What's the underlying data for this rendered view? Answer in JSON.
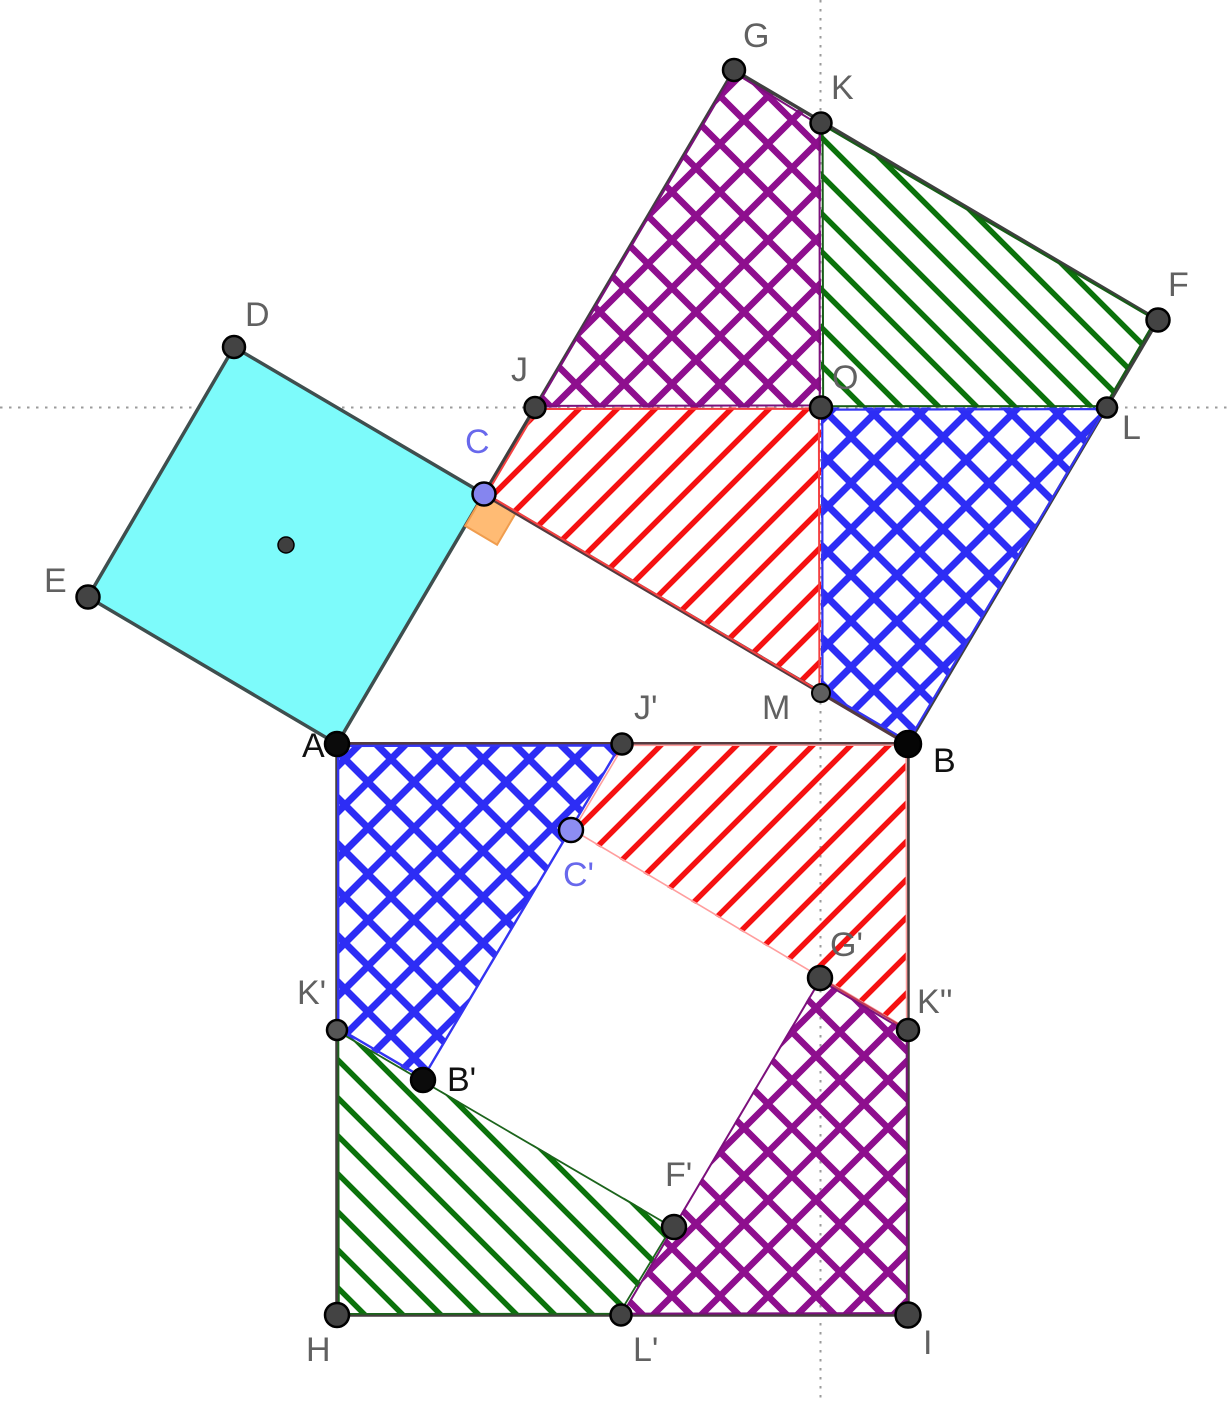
{
  "figure": {
    "canvas": {
      "w": 1227,
      "h": 1401,
      "background": "#ffffff"
    },
    "patterns": [
      {
        "id": "redHatch",
        "size": 38,
        "dirs": [
          "up"
        ],
        "color": "#f51111",
        "width": 5.5
      },
      {
        "id": "greenHatch",
        "size": 38,
        "dirs": [
          "down"
        ],
        "color": "#0b720b",
        "width": 5.5
      },
      {
        "id": "blueCross",
        "size": 46,
        "dirs": [
          "up",
          "down"
        ],
        "color": "#2d2df5",
        "width": 7
      },
      {
        "id": "purpleCross",
        "size": 48,
        "dirs": [
          "up",
          "down"
        ],
        "color": "#8e0f8e",
        "width": 6.5
      }
    ],
    "points": {
      "A": [
        337,
        744
      ],
      "B": [
        908,
        744
      ],
      "C": [
        484,
        494
      ],
      "D": [
        234,
        347
      ],
      "E": [
        88,
        597
      ],
      "G": [
        734,
        70
      ],
      "K": [
        821,
        123
      ],
      "F": [
        1158,
        320
      ],
      "J": [
        535,
        407.5
      ],
      "O": [
        821,
        407.5
      ],
      "L": [
        1107,
        407.5
      ],
      "M": [
        821,
        693
      ],
      "H": [
        337,
        1315
      ],
      "I": [
        908,
        1315
      ],
      "J2": [
        622,
        744
      ],
      "C2": [
        571,
        830
      ],
      "B2": [
        423,
        1080
      ],
      "K2": [
        337,
        1030
      ],
      "K3": [
        908,
        1030
      ],
      "G2": [
        820,
        978
      ],
      "F2": [
        674,
        1227
      ],
      "L2": [
        621,
        1315
      ],
      "CTR": [
        286,
        545
      ]
    },
    "layers": [
      {
        "kind": "dotline",
        "name": "ref-line-horizontal",
        "pts": [
          [
            0,
            407.5
          ],
          [
            1227,
            407.5
          ]
        ],
        "stroke": "#9b9b9b",
        "width": 2,
        "dash": "2.5 6.5",
        "inter": false
      },
      {
        "kind": "dotline",
        "name": "ref-line-vertical",
        "pts": [
          [
            820.5,
            0
          ],
          [
            820.5,
            1401
          ]
        ],
        "stroke": "#9b9b9b",
        "width": 2,
        "dash": "2.5 6.5",
        "inter": false
      },
      {
        "kind": "fill",
        "name": "square-ACDE",
        "pts": [
          "A",
          "C",
          "D",
          "E"
        ],
        "fill": "#7dfbfb",
        "stroke": "#3f4e4e",
        "width": 3.5,
        "inter": true
      },
      {
        "kind": "fill",
        "name": "right-angle-marker",
        "pts": [
          [
            484,
            494
          ],
          [
            515.9,
            512.8
          ],
          [
            497.1,
            544.7
          ],
          [
            465.2,
            525.9
          ]
        ],
        "fill": "#ffbb74",
        "stroke": "#f09d4e",
        "width": 2,
        "inter": false
      },
      {
        "kind": "fill",
        "name": "piece-upper-red",
        "pts": [
          "J",
          "O",
          "M",
          "C"
        ],
        "fill": "pattern:redHatch",
        "inter": true
      },
      {
        "kind": "fill",
        "name": "piece-upper-purple",
        "pts": [
          "G",
          "K",
          "O",
          "J"
        ],
        "fill": "pattern:purpleCross",
        "inter": true
      },
      {
        "kind": "fill",
        "name": "piece-upper-green",
        "pts": [
          "K",
          "F",
          "L",
          "O"
        ],
        "fill": "pattern:greenHatch",
        "inter": true
      },
      {
        "kind": "fill",
        "name": "piece-upper-blue",
        "pts": [
          "O",
          "L",
          "B",
          "M"
        ],
        "fill": "pattern:blueCross",
        "inter": true
      },
      {
        "kind": "fill",
        "name": "piece-lower-green",
        "pts": [
          "K2",
          "F2",
          "L2",
          "H"
        ],
        "fill": "pattern:greenHatch",
        "inter": true
      },
      {
        "kind": "fill",
        "name": "piece-lower-purple",
        "pts": [
          "G2",
          "K3",
          "I",
          "L2"
        ],
        "fill": "pattern:purpleCross",
        "inter": true
      },
      {
        "kind": "fill",
        "name": "piece-lower-red",
        "pts": [
          "J2",
          "B",
          "K3",
          "C2"
        ],
        "fill": "pattern:redHatch",
        "inter": true
      },
      {
        "kind": "fill",
        "name": "piece-lower-blue",
        "pts": [
          "A",
          "J2",
          "B2",
          "K2"
        ],
        "fill": "pattern:blueCross",
        "inter": true
      },
      {
        "kind": "edge",
        "name": "square-CGFB-border",
        "pts": [
          "C",
          "G",
          "F",
          "B"
        ],
        "stroke": "#3f3f3f",
        "width": 3.5,
        "inset": 0,
        "close": true,
        "inter": true
      },
      {
        "kind": "seg",
        "name": "side-CB",
        "pts": [
          "C",
          "B"
        ],
        "stroke": "#553b40",
        "width": 4,
        "inter": true
      },
      {
        "kind": "seg",
        "name": "side-AB",
        "pts": [
          "A",
          "B"
        ],
        "stroke": "#553b40",
        "width": 4,
        "inter": true
      },
      {
        "kind": "edge",
        "name": "square-ABIH-border",
        "pts": [
          "B",
          "I",
          "H",
          "A"
        ],
        "stroke": "#453e3e",
        "width": 3.5,
        "inset": 0,
        "close": false,
        "inter": true
      },
      {
        "kind": "edge",
        "name": "piece-upper-red-edge",
        "pts": [
          "J",
          "O",
          "M",
          "C"
        ],
        "stroke": "#f54040",
        "width": 2,
        "inset": 2.5,
        "close": true,
        "inter": false
      },
      {
        "kind": "edge",
        "name": "piece-upper-purple-edge",
        "pts": [
          "G",
          "K",
          "O",
          "J"
        ],
        "stroke": "#7c107c",
        "width": 2,
        "inset": 2.5,
        "close": true,
        "inter": false
      },
      {
        "kind": "edge",
        "name": "piece-upper-green-edge",
        "pts": [
          "K",
          "F",
          "L",
          "O"
        ],
        "stroke": "#175c17",
        "width": 2,
        "inset": 2.5,
        "close": true,
        "inter": false
      },
      {
        "kind": "edge",
        "name": "piece-upper-blue-edge",
        "pts": [
          "O",
          "L",
          "B",
          "M"
        ],
        "stroke": "#3434f2",
        "width": 2.2,
        "inset": 2.5,
        "close": true,
        "inter": false
      },
      {
        "kind": "edge",
        "name": "piece-lower-green-edge",
        "pts": [
          "K2",
          "F2",
          "L2",
          "H"
        ],
        "stroke": "#1c641c",
        "width": 1.8,
        "inset": 2.2,
        "close": true,
        "inter": false
      },
      {
        "kind": "edge",
        "name": "piece-lower-purple-edge",
        "pts": [
          "G2",
          "K3",
          "I",
          "L2"
        ],
        "stroke": "#7c107c",
        "width": 2,
        "inset": 2.2,
        "close": true,
        "inter": false
      },
      {
        "kind": "edge",
        "name": "piece-lower-red-edge",
        "pts": [
          "J2",
          "B",
          "K3",
          "C2"
        ],
        "stroke": "#ff9e9e",
        "width": 1.6,
        "inset": 2.2,
        "close": true,
        "inter": false
      },
      {
        "kind": "seg",
        "name": "edge-G2-K3-crimson",
        "pts": [
          "G2",
          "K3"
        ],
        "stroke": "#c23a55",
        "width": 2,
        "inter": false
      },
      {
        "kind": "edge",
        "name": "piece-lower-blue-edge",
        "pts": [
          "A",
          "J2",
          "B2",
          "K2"
        ],
        "stroke": "#3434f2",
        "width": 2.4,
        "inset": 2.2,
        "close": true,
        "inter": false
      }
    ],
    "dots": [
      {
        "name": "G",
        "p": "G",
        "r": 11,
        "fill": "#434343",
        "sw": 2.5
      },
      {
        "name": "K",
        "p": "K",
        "r": 10.5,
        "fill": "#434343",
        "sw": 2.5
      },
      {
        "name": "F",
        "p": "F",
        "r": 11.5,
        "fill": "#434343",
        "sw": 2.5
      },
      {
        "name": "D",
        "p": "D",
        "r": 11,
        "fill": "#434343",
        "sw": 2.5
      },
      {
        "name": "J",
        "p": "J",
        "r": 10.5,
        "fill": "#434343",
        "sw": 2.5
      },
      {
        "name": "O",
        "p": "O",
        "r": 11,
        "fill": "#434343",
        "sw": 2.5
      },
      {
        "name": "L",
        "p": "L",
        "r": 10,
        "fill": "#434343",
        "sw": 2.5
      },
      {
        "name": "C",
        "p": "C",
        "r": 11.5,
        "fill": "#8585ef",
        "sw": 2.5
      },
      {
        "name": "E",
        "p": "E",
        "r": 11.5,
        "fill": "#434343",
        "sw": 2.5
      },
      {
        "name": "center-ACDE",
        "p": "CTR",
        "r": 8,
        "fill": "#3f3f3f",
        "sw": 1.5
      },
      {
        "name": "M",
        "p": "M",
        "r": 9,
        "fill": "#5f5f5f",
        "sw": 2
      },
      {
        "name": "A",
        "p": "A",
        "r": 12,
        "fill": "#0b0b0b",
        "sw": 2.5
      },
      {
        "name": "J-prime",
        "p": "J2",
        "r": 10.5,
        "fill": "#434343",
        "sw": 2.5
      },
      {
        "name": "B",
        "p": "B",
        "r": 13,
        "fill": "#050505",
        "sw": 2.5
      },
      {
        "name": "C-prime",
        "p": "C2",
        "r": 12,
        "fill": "#8d8df2",
        "sw": 2.5
      },
      {
        "name": "K-prime",
        "p": "K2",
        "r": 10,
        "fill": "#555555",
        "sw": 2.5
      },
      {
        "name": "G-prime",
        "p": "G2",
        "r": 12,
        "fill": "#434343",
        "sw": 2.5
      },
      {
        "name": "K-double-prime",
        "p": "K3",
        "r": 11,
        "fill": "#434343",
        "sw": 2.5
      },
      {
        "name": "B-prime",
        "p": "B2",
        "r": 12,
        "fill": "#0b0b0b",
        "sw": 2.5
      },
      {
        "name": "F-prime",
        "p": "F2",
        "r": 12,
        "fill": "#434343",
        "sw": 2.5
      },
      {
        "name": "H",
        "p": "H",
        "r": 12,
        "fill": "#434343",
        "sw": 2.5
      },
      {
        "name": "L-prime",
        "p": "L2",
        "r": 10.5,
        "fill": "#434343",
        "sw": 2.5
      },
      {
        "name": "I",
        "p": "I",
        "r": 12.5,
        "fill": "#434343",
        "sw": 2.5
      }
    ],
    "labels": [
      {
        "name": "label-G",
        "text": "G",
        "x": 743,
        "y": 47,
        "color": "#616161",
        "size": 34
      },
      {
        "name": "label-K",
        "text": "K",
        "x": 831,
        "y": 99,
        "color": "#616161",
        "size": 34
      },
      {
        "name": "label-F",
        "text": "F",
        "x": 1168,
        "y": 296,
        "color": "#616161",
        "size": 34
      },
      {
        "name": "label-D",
        "text": "D",
        "x": 245,
        "y": 326,
        "color": "#616161",
        "size": 34
      },
      {
        "name": "label-J",
        "text": "J",
        "x": 511,
        "y": 381,
        "color": "#616161",
        "size": 34
      },
      {
        "name": "label-O",
        "text": "O",
        "x": 832,
        "y": 389,
        "color": "#616161",
        "size": 34
      },
      {
        "name": "label-L",
        "text": "L",
        "x": 1122,
        "y": 439,
        "color": "#616161",
        "size": 34
      },
      {
        "name": "label-C",
        "text": "C",
        "x": 465,
        "y": 453,
        "color": "#6868ec",
        "size": 34
      },
      {
        "name": "label-E",
        "text": "E",
        "x": 44,
        "y": 592,
        "color": "#616161",
        "size": 34
      },
      {
        "name": "label-M",
        "text": "M",
        "x": 762,
        "y": 719,
        "color": "#616161",
        "size": 34
      },
      {
        "name": "label-A",
        "text": "A",
        "x": 302,
        "y": 757,
        "color": "#111111",
        "size": 34
      },
      {
        "name": "label-B",
        "text": "B",
        "x": 933,
        "y": 772,
        "color": "#111111",
        "size": 34
      },
      {
        "name": "label-J-prime",
        "text": "J'",
        "x": 634,
        "y": 719,
        "color": "#616161",
        "size": 34
      },
      {
        "name": "label-C-prime",
        "text": "C'",
        "x": 563,
        "y": 886,
        "color": "#6868ec",
        "size": 34
      },
      {
        "name": "label-G-prime",
        "text": "G'",
        "x": 830,
        "y": 956,
        "color": "#616161",
        "size": 34
      },
      {
        "name": "label-K-prime",
        "text": "K'",
        "x": 297,
        "y": 1004,
        "color": "#616161",
        "size": 34
      },
      {
        "name": "label-K-double-prime",
        "text": "K''",
        "x": 917,
        "y": 1013,
        "color": "#616161",
        "size": 34
      },
      {
        "name": "label-B-prime",
        "text": "B'",
        "x": 447,
        "y": 1091,
        "color": "#111111",
        "size": 34
      },
      {
        "name": "label-F-prime",
        "text": "F'",
        "x": 665,
        "y": 1186,
        "color": "#616161",
        "size": 34
      },
      {
        "name": "label-H",
        "text": "H",
        "x": 306,
        "y": 1361,
        "color": "#616161",
        "size": 34
      },
      {
        "name": "label-L-prime",
        "text": "L'",
        "x": 633,
        "y": 1361,
        "color": "#616161",
        "size": 34
      },
      {
        "name": "label-I",
        "text": "I",
        "x": 923,
        "y": 1354,
        "color": "#616161",
        "size": 34
      }
    ]
  }
}
